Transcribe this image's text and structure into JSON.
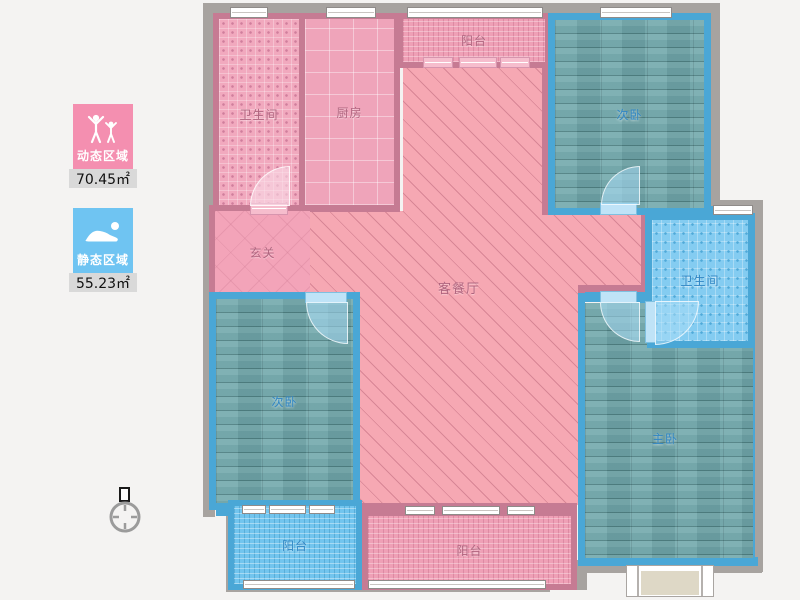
{
  "legend": {
    "dynamic": {
      "label": "动态区域",
      "value": "70.45㎡",
      "color": "#f48fb0",
      "icon": "people-active-icon"
    },
    "static": {
      "label": "静态区域",
      "value": "55.23㎡",
      "color": "#6fc4f2",
      "icon": "person-sleeping-icon"
    }
  },
  "rooms": [
    {
      "id": "bathroom-top",
      "label": "卫生间",
      "zone": "dynamic"
    },
    {
      "id": "kitchen",
      "label": "厨房",
      "zone": "dynamic"
    },
    {
      "id": "balcony-top",
      "label": "阳台",
      "zone": "dynamic"
    },
    {
      "id": "bedroom-top-right",
      "label": "次卧",
      "zone": "static"
    },
    {
      "id": "hallway",
      "label": "玄关",
      "zone": "dynamic"
    },
    {
      "id": "living-dining",
      "label": "客餐厅",
      "zone": "dynamic"
    },
    {
      "id": "bathroom-right",
      "label": "卫生间",
      "zone": "static"
    },
    {
      "id": "bedroom-left",
      "label": "次卧",
      "zone": "static"
    },
    {
      "id": "bedroom-master",
      "label": "主卧",
      "zone": "static"
    },
    {
      "id": "balcony-bottom-left",
      "label": "阳台",
      "zone": "static"
    },
    {
      "id": "balcony-bottom-mid",
      "label": "阳台",
      "zone": "dynamic"
    }
  ],
  "colors": {
    "wall_outer": "#a7a3a0",
    "wall_dynamic": "#c67b93",
    "wall_static": "#4aa7d6",
    "floor_dynamic": "#f1a9be",
    "floor_static_wood": "#73a8ab",
    "floor_static_tile": "#84ccf1"
  },
  "compass": {
    "name": "north-indicator"
  }
}
